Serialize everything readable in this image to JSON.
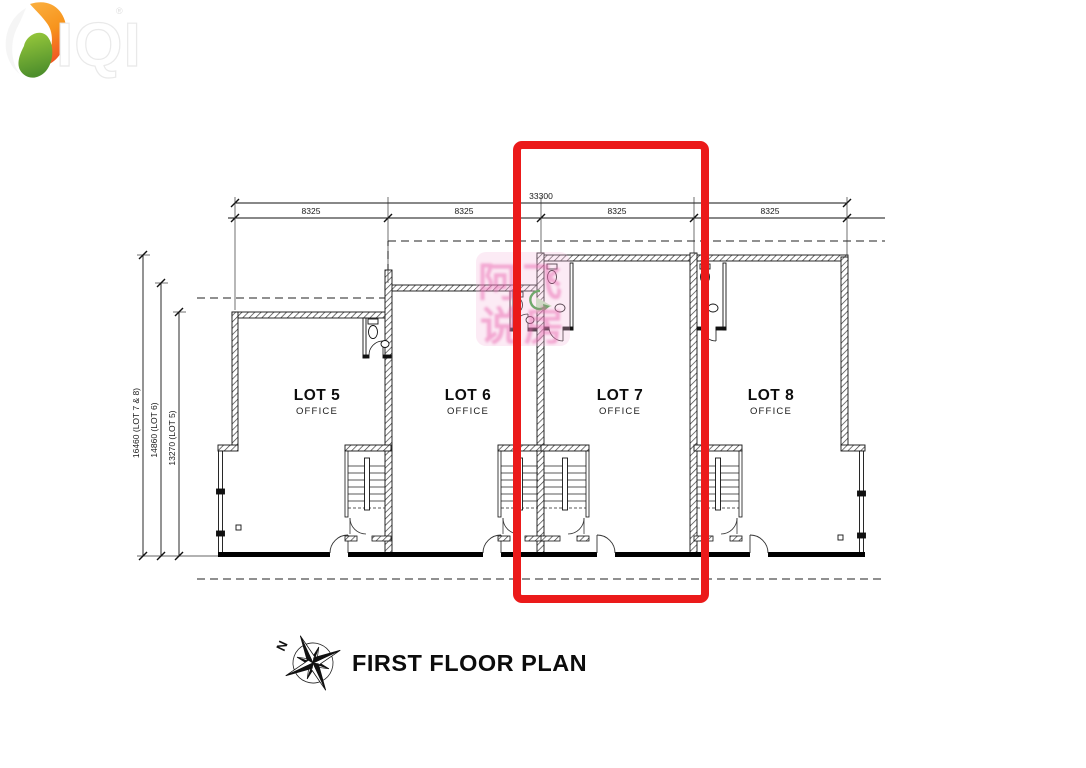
{
  "page": {
    "background": "#ffffff"
  },
  "logo": {
    "brand": "IQI",
    "registered": "®",
    "colors": {
      "orange": "#F9A01B",
      "deep_orange": "#F15A24",
      "green": "#8DC63F",
      "deep_green": "#4E8F2C"
    }
  },
  "dimensions": {
    "top_total": {
      "label": "33300"
    },
    "top_segments": [
      "8325",
      "8325",
      "8325",
      "8325"
    ],
    "left": [
      {
        "label": "16460 (LOT 7 & 8)"
      },
      {
        "label": "14860 (LOT 6)"
      },
      {
        "label": "13270 (LOT 5)"
      }
    ]
  },
  "lots": [
    {
      "name": "LOT 5",
      "use": "OFFICE"
    },
    {
      "name": "LOT 6",
      "use": "OFFICE"
    },
    {
      "name": "LOT 7",
      "use": "OFFICE"
    },
    {
      "name": "LOT 8",
      "use": "OFFICE"
    }
  ],
  "highlight": {
    "color": "#EB1A1A"
  },
  "watermark": {
    "line1": "阿飞",
    "line2": "说房",
    "color": "#E964AE"
  },
  "compass": {
    "north_label": "N"
  },
  "title": {
    "text": "FIRST FLOOR PLAN"
  }
}
